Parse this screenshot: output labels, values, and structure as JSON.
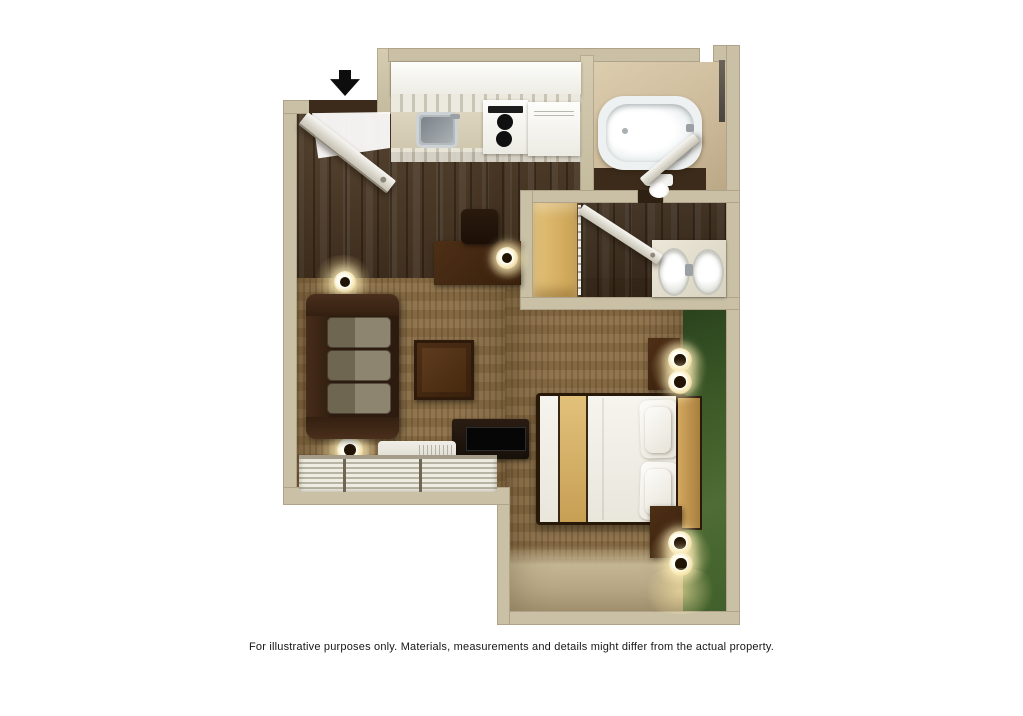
{
  "caption": {
    "text": "For illustrative purposes only.  Materials, measurements and details might differ from the actual property."
  },
  "floor_plan": {
    "title": "Studio suite 3D floor plan (top-down render)",
    "entrance_marker": "black-down-arrow",
    "colors": {
      "background": "#ffffff",
      "wall_tan": "#c9c0a5",
      "wood_floor": "#49341f",
      "carpet_brown": "#8a6e46",
      "accent_wall_green": "#436028",
      "counter_beige": "#d9d1bb",
      "bedding_white": "#f4f2ec",
      "bedding_tan_stripe": "#d8b878",
      "dark_furniture": "#3a2413"
    },
    "rooms": [
      {
        "name": "Entry",
        "features": [
          "entry-door",
          "entrance-arrow"
        ]
      },
      {
        "name": "Kitchen",
        "features": [
          "upper-cabinets",
          "counter",
          "sink",
          "stove-with-two-burners",
          "refrigerator"
        ]
      },
      {
        "name": "Bathroom",
        "features": [
          "bathtub",
          "toilet",
          "bathroom-door",
          "wall-mirror-strip"
        ]
      },
      {
        "name": "Dressing area",
        "features": [
          "closet-shelves",
          "closet-rod",
          "double-sink-vanity",
          "vanity-door"
        ]
      },
      {
        "name": "Living area",
        "features": [
          "sofa",
          "coffee-table",
          "wall-mirror",
          "wall-sconce-upper",
          "wall-sconce-lower",
          "desk",
          "desk-chair",
          "desk-lamp",
          "tv-console",
          "tv",
          "ac-unit",
          "window-blinds"
        ]
      },
      {
        "name": "Sleeping area",
        "features": [
          "bed",
          "headboard",
          "pillows",
          "nightstand-upper",
          "nightstand-lower",
          "table-lamps",
          "green-accent-wall",
          "lit-floor-strip"
        ]
      }
    ]
  }
}
